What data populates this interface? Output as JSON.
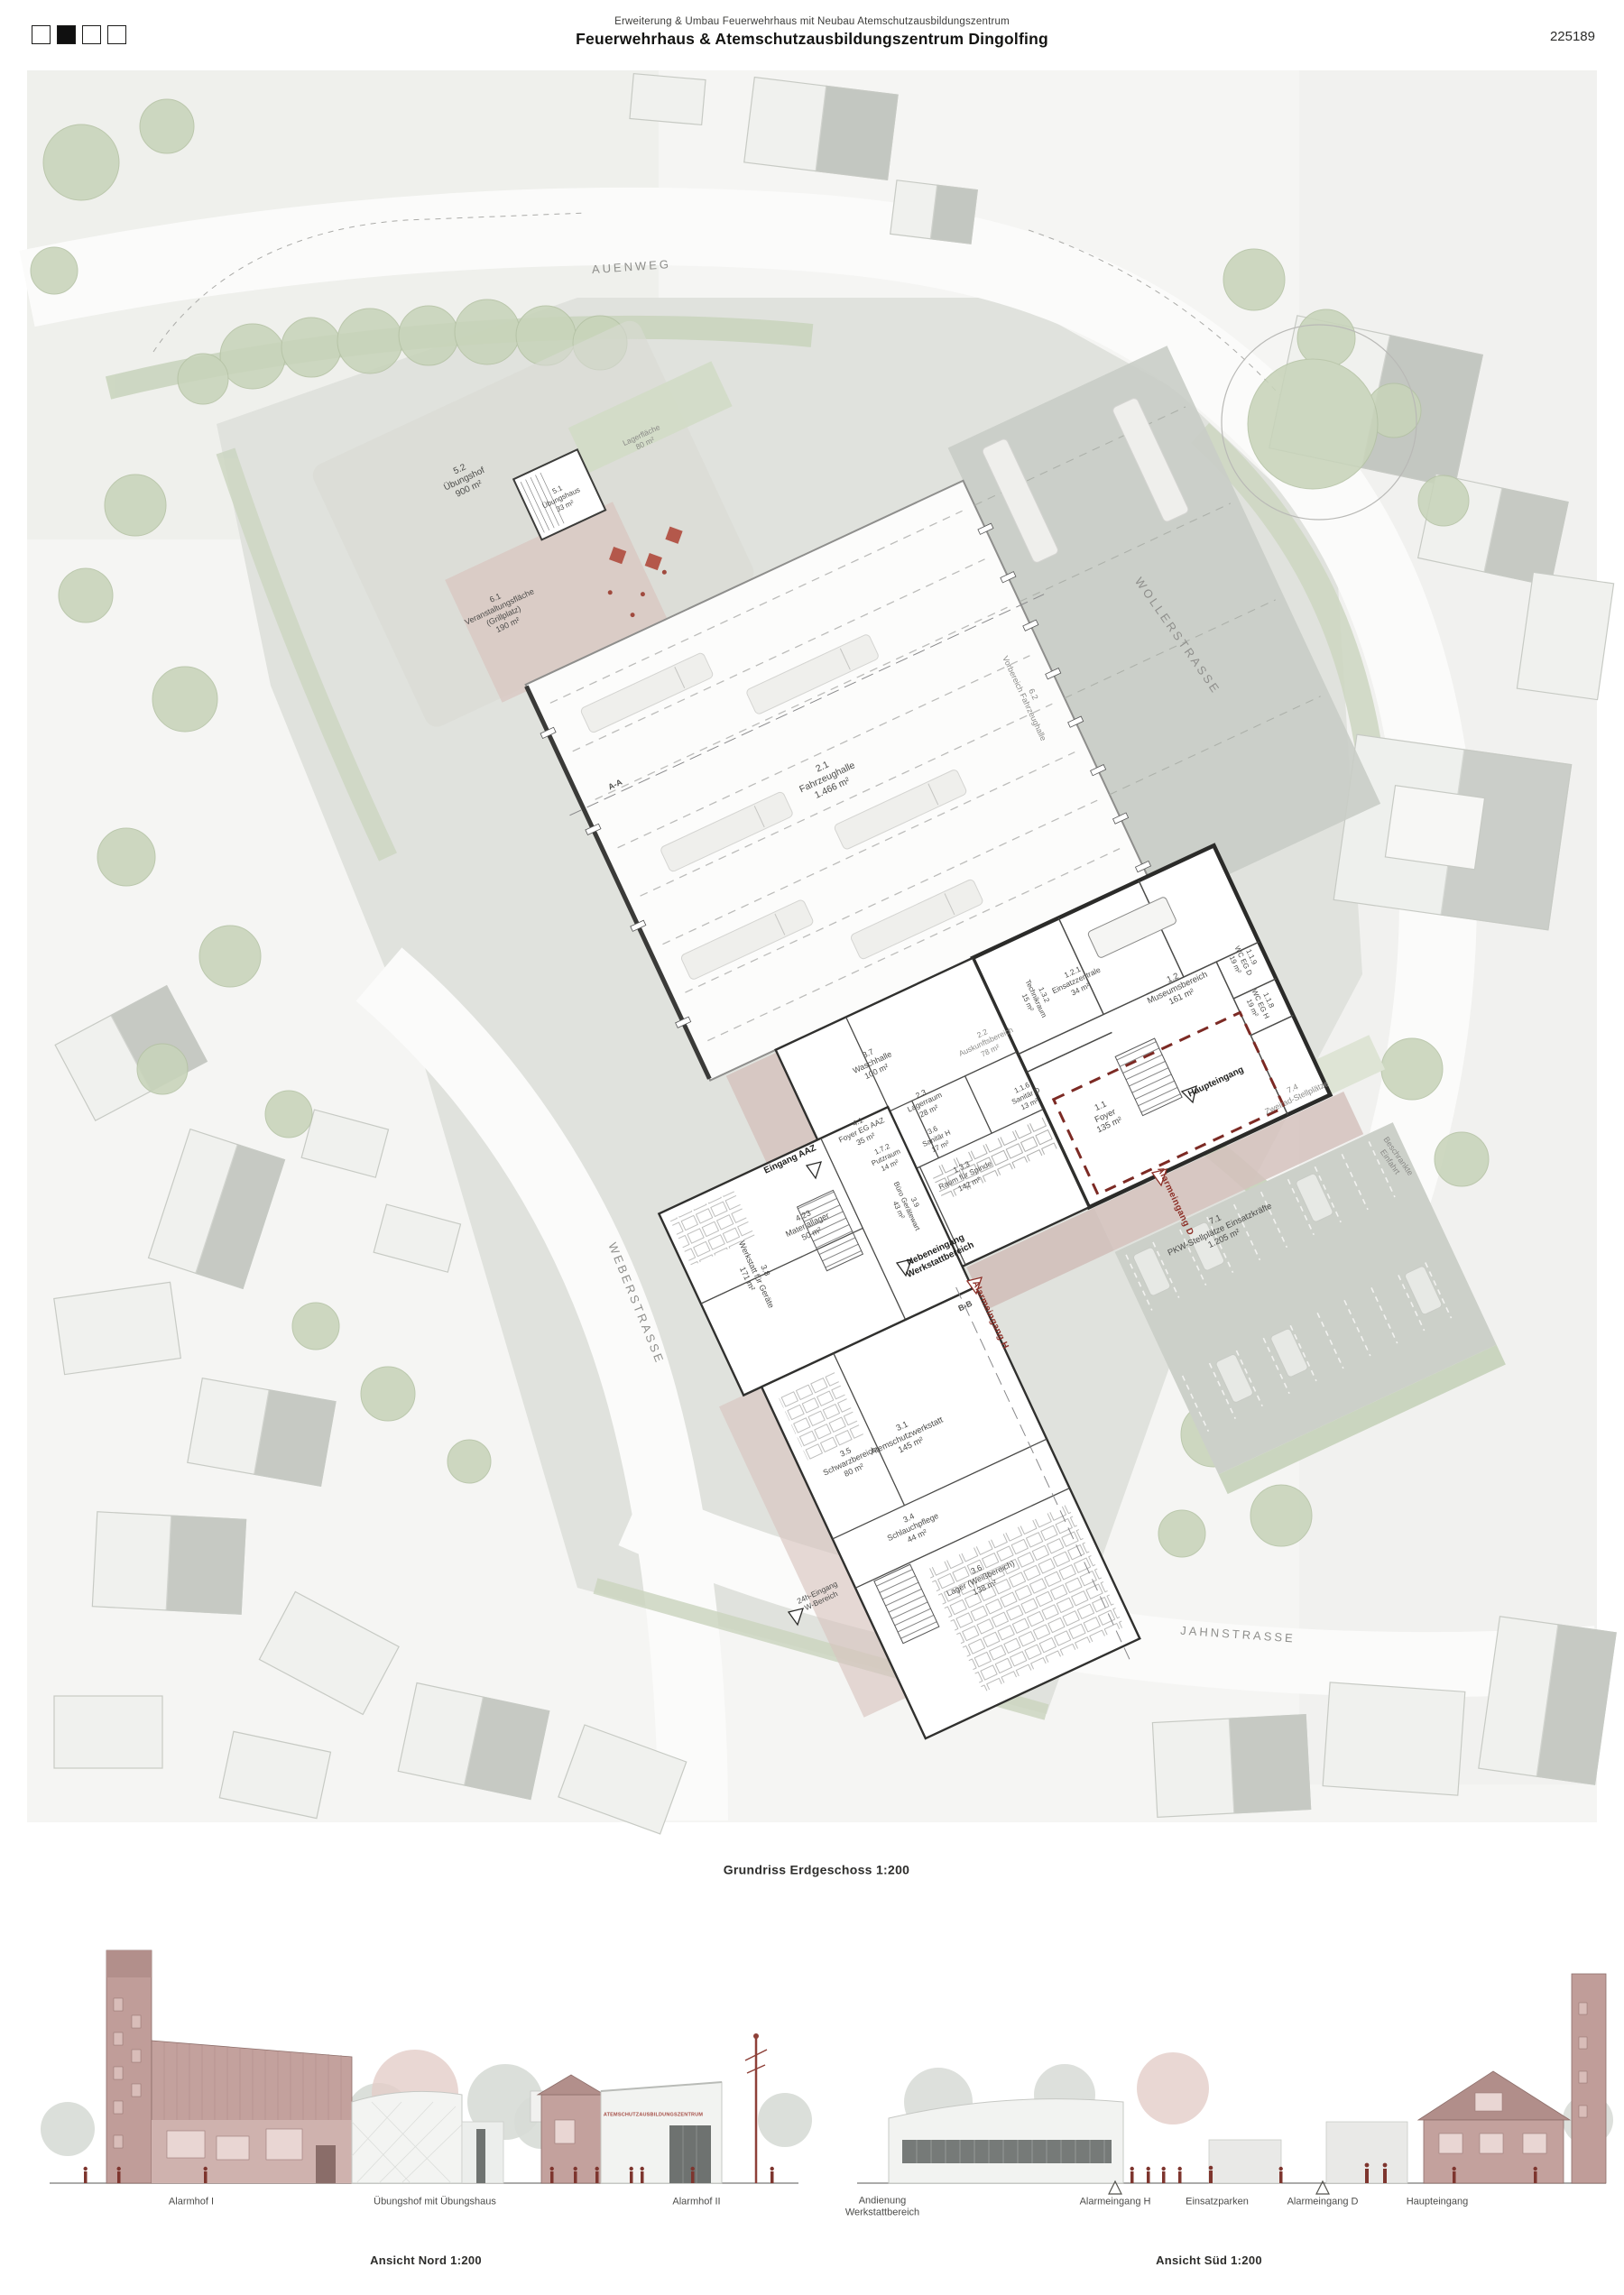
{
  "header": {
    "subtitle": "Erweiterung & Umbau Feuerwehrhaus mit Neubau Atemschutzausbildungszentrum",
    "title": "Feuerwehrhaus & Atemschutzausbildungszentrum Dingolfing",
    "project_number": "225189",
    "page_indicator": {
      "squares": 4,
      "active_index": 2
    }
  },
  "plan": {
    "caption": "Grundriss Erdgeschoss 1:200",
    "labels": [
      "AUENWEG",
      "WOLLERSTRASSE",
      "WEBERSTRASSE",
      "JAHNSTRASSE",
      "5.2\nÜbungshof\n900 m²",
      "5.1\nÜbungshaus\n33 m²",
      "Lagerfläche\n80 m²",
      "6.1\nVeranstaltungsfläche\n(Grillplatz)\n190 m²",
      "2.1\nFahrzeughalle\n1.466 m²",
      "6.2\nVorbereich Fahrzeughalle",
      "1.2.1\nEinsatzzentrale\n34 m²",
      "1.3.2\nTechnikraum\n15 m²",
      "1.2\nMuseumsbereich\n161 m²",
      "1.1.9\nWC EG D\n19 m²",
      "1.1.8\nWC EG H\n19 m²",
      "2.2\nAuskunftsbereich\n78 m²",
      "3.7\nWaschhalle\n100 m²",
      "2.3\nLagerraum\n28 m²",
      "4.1\nFoyer EG AAZ\n35 m²",
      "1.7.2\nPutzraum\n14 m²",
      "3.6\nSanitär H\n17 m²",
      "1.1.6\nSanitär D\n13 m²",
      "1.3.3\nRaum für Spinde\n142 m²",
      "3.9\nBüro Gerätewart\n43 m²",
      "1.1\nFoyer\n135 m²",
      "4.23\nMateriallager\n50 m²",
      "3.8\nWerkstatt für Geräte\n171 m²",
      "3.1\nAtemschutzwerkstatt\n145 m²",
      "3.5\nSchwarzbereich\n80 m²",
      "3.4\nSchlauchpflege\n44 m²",
      "3.6\nLager (Weißbereich)\n138 m²",
      "7.1\nPKW-Stellplätze Einsatzkräfte\n1.205 m²",
      "7.4\nZweirad-Stellplätze",
      "Beschrankte\nEinfahrt",
      "Haupteingang",
      "Eingang AAZ",
      "Nebeneingang\nWerkstattbereich",
      "Alarmeingang H",
      "Alarmeingang D",
      "24h-Eingang\nW-Bereich",
      "A-A",
      "B-B"
    ]
  },
  "elevations": {
    "north": {
      "caption": "Ansicht Nord 1:200",
      "labels": [
        "Alarmhof I",
        "Übungshof mit Übungshaus",
        "Alarmhof II"
      ],
      "building_sign": "ATEMSCHUTZAUSBILDUNGSZENTRUM"
    },
    "south": {
      "caption": "Ansicht Süd 1:200",
      "labels": [
        "Andienung\nWerkstattbereich",
        "Alarmeingang H",
        "Einsatzparken",
        "Alarmeingang D",
        "Haupteingang"
      ],
      "marker_glyph": "△"
    }
  }
}
